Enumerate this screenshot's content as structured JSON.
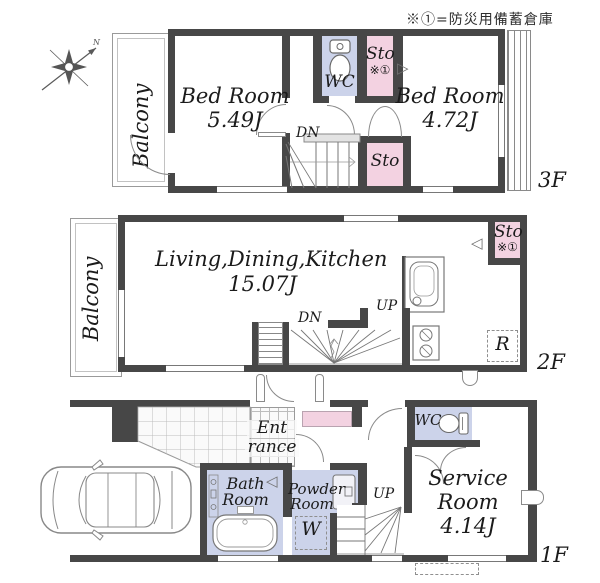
{
  "note": "※①=防災用備蓄倉庫",
  "compass": {
    "north": "N"
  },
  "floors": {
    "f3": {
      "label": "3F",
      "balcony": "Balcony",
      "bedroom1": {
        "name": "Bed Room",
        "size": "5.49J"
      },
      "wc": "WC",
      "sto1": {
        "name": "Sto",
        "mark": "※①"
      },
      "bedroom2": {
        "name": "Bed Room",
        "size": "4.72J"
      },
      "sto2": "Sto",
      "dn": "DN"
    },
    "f2": {
      "label": "2F",
      "balcony": "Balcony",
      "ldk": {
        "name": "Living,Dining,Kitchen",
        "size": "15.07J"
      },
      "sto": {
        "name": "Sto",
        "mark": "※①"
      },
      "dn": "DN",
      "up": "UP",
      "fridge": "R"
    },
    "f1": {
      "label": "1F",
      "entrance": {
        "line1": "Ent",
        "line2": "rance"
      },
      "bath": {
        "line1": "Bath",
        "line2": "Room"
      },
      "powder": {
        "line1": "Powder",
        "line2": "Room"
      },
      "washer": "W",
      "wc": "WC",
      "service": {
        "line1": "Service",
        "line2": "Room",
        "size": "4.14J"
      },
      "up": "UP"
    }
  }
}
